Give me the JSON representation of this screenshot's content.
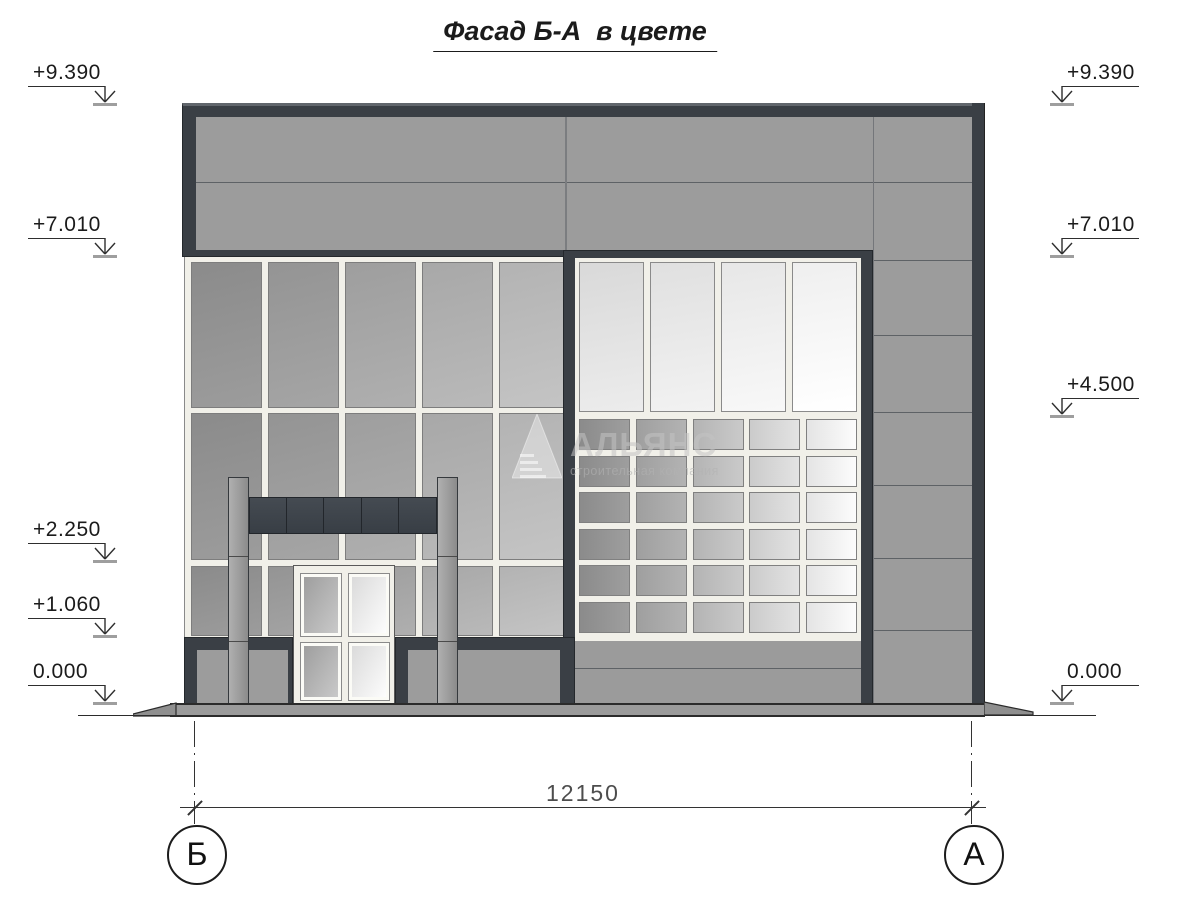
{
  "title": "Фасад Б-А  в цвете",
  "elevations": {
    "left": [
      {
        "label": "+9.390"
      },
      {
        "label": "+7.010"
      },
      {
        "label": "+2.250"
      },
      {
        "label": "+1.060"
      },
      {
        "label": "0.000"
      }
    ],
    "right": [
      {
        "label": "+9.390"
      },
      {
        "label": "+7.010"
      },
      {
        "label": "+4.500"
      },
      {
        "label": "0.000"
      }
    ]
  },
  "dimension": {
    "value": "12150"
  },
  "axes": [
    {
      "label": "Б"
    },
    {
      "label": "А"
    }
  ],
  "watermark": {
    "name": "АЛЬЯНС",
    "tagline": "строительная компания"
  },
  "icons": {
    "elevation_arrow": "open-v-down-arrow",
    "axis_marker": "circle-with-letter",
    "logo": "striped-pyramid"
  },
  "colors": {
    "frame_dark": "#3a3f45",
    "panel_gray": "#9c9c9c",
    "mullion_white": "#f1f0e9",
    "seam": "#5e6266",
    "beam_dark": "#3e444b",
    "ground": "#9b9b9b",
    "line": "#333333",
    "dim_text": "#4d4d4d",
    "curtain_columns": [
      [
        "#8b8b8b",
        "#9c9c9c"
      ],
      [
        "#949494",
        "#a5a5a5"
      ],
      [
        "#9e9e9e",
        "#afafaf"
      ],
      [
        "#a8a8a8",
        "#b9b9b9"
      ],
      [
        "#b3b3b3",
        "#c4c4c4"
      ]
    ],
    "glass_top_columns": [
      [
        "#d9d9d9",
        "#ececec"
      ],
      [
        "#e0e0e0",
        "#f2f2f2"
      ],
      [
        "#e7e7e7",
        "#f8f8f8"
      ],
      [
        "#efefef",
        "#ffffff"
      ]
    ],
    "grid_columns": [
      [
        "#8b8b8b",
        "#9e9e9e"
      ],
      [
        "#9f9f9f",
        "#b3b3b3"
      ],
      [
        "#b4b4b4",
        "#cacaca"
      ],
      [
        "#cbcbcb",
        "#e3e3e3"
      ],
      [
        "#e4e4e4",
        "#fcfcfc"
      ]
    ],
    "door_leaf_left": [
      "#9b9b9b",
      "#cccccc"
    ],
    "door_leaf_right": [
      "#d8d8d8",
      "#ffffff"
    ],
    "pylon": [
      "#b0b0b0",
      "#8b8b8b"
    ]
  }
}
